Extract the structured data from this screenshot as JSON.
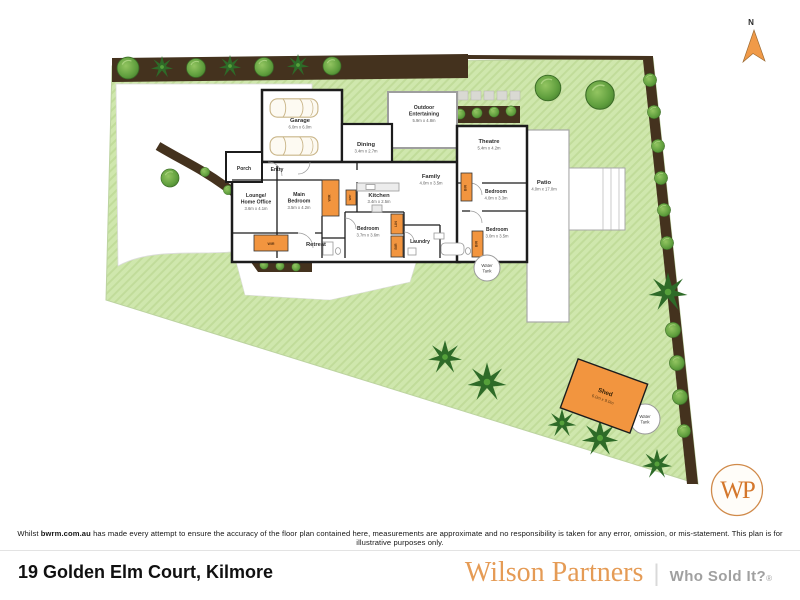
{
  "plan": {
    "north_label": "N",
    "rooms": [
      {
        "line1": "Garage",
        "line2": "",
        "dims": "6.0m x 6.0m"
      },
      {
        "line1": "Porch",
        "line2": "",
        "dims": ""
      },
      {
        "line1": "Entry",
        "line2": "",
        "dims": ""
      },
      {
        "line1": "Lounge/",
        "line2": "Home Office",
        "dims": "3.6m x 4.1m"
      },
      {
        "line1": "Main",
        "line2": "Bedroom",
        "dims": "3.5m x 4.2m"
      },
      {
        "line1": "Retreat",
        "line2": "",
        "dims": ""
      },
      {
        "line1": "Dining",
        "line2": "",
        "dims": "3.4m x 2.7m"
      },
      {
        "line1": "Kitchen",
        "line2": "",
        "dims": "3.4m x 2.5m"
      },
      {
        "line1": "Family",
        "line2": "",
        "dims": "4.0m x 3.5m"
      },
      {
        "line1": "Outdoor",
        "line2": "Entertaining",
        "dims": "5.9m x 4.8m"
      },
      {
        "line1": "Theatre",
        "line2": "",
        "dims": "5.4m x 4.2m"
      },
      {
        "line1": "Bedroom",
        "line2": "",
        "dims": "4.0m x 3.3m"
      },
      {
        "line1": "Patio",
        "line2": "",
        "dims": "4.0m x 17.0m"
      },
      {
        "line1": "Bedroom",
        "line2": "",
        "dims": "3.7m x 3.6m"
      },
      {
        "line1": "Laundry",
        "line2": "",
        "dims": ""
      },
      {
        "line1": "Bedroom",
        "line2": "",
        "dims": "3.0m x 3.5m"
      }
    ],
    "storage": {
      "wir_a": "WIR",
      "wir_b": "WIR",
      "wip": "WIP",
      "bir_a": "BIR",
      "bir_b": "BIR",
      "bir_c": "BIR",
      "linen": "LIN"
    },
    "shed": {
      "name": "Shed",
      "dims": "6.0m x 9.0m"
    },
    "water_tanks": [
      {
        "line1": "Water",
        "line2": "Tank"
      },
      {
        "line1": "Water",
        "line2": "Tank"
      }
    ],
    "logo": {
      "monogram": "WP"
    }
  },
  "colors": {
    "accent_orange": "#F2953F",
    "brand_orange": "#E59B55",
    "lawn_green": "#CFE7AD",
    "hedge_brown": "#44321E",
    "wall_black": "#1C1C1C"
  },
  "disclaimer": {
    "prefix": "Whilst ",
    "bold": "bwrm.com.au",
    "rest": " has made every attempt to ensure the accuracy of the floor plan contained here, measurements are approximate and no responsibility is taken for any error, omission, or mis-statement. This plan is for illustrative purposes only."
  },
  "footer": {
    "address": "19 Golden Elm Court, Kilmore",
    "brand_name": "Wilson Partners",
    "brand_divider": "|",
    "tagline": "Who Sold It?",
    "registered": "®"
  }
}
